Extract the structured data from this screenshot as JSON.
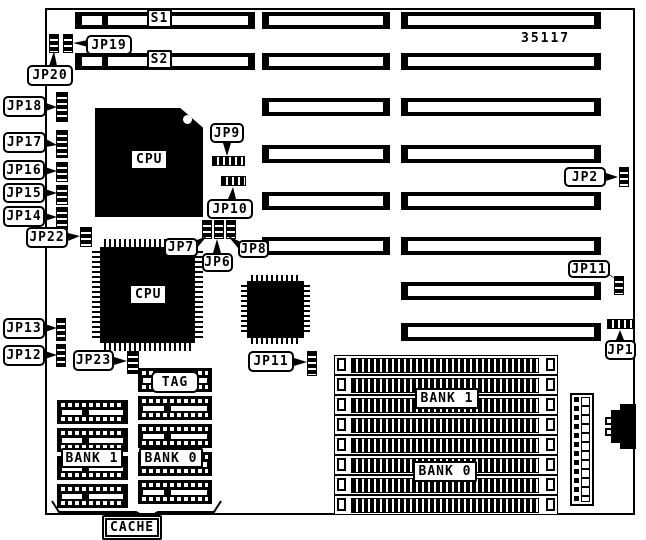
{
  "board": {
    "part_number": "35117"
  },
  "slots": {
    "s1": "S1",
    "s2": "S2"
  },
  "chips": {
    "cpu1": "CPU",
    "cpu2": "CPU"
  },
  "jumpers": {
    "jp1": "JP1",
    "jp2": "JP2",
    "jp6": "JP6",
    "jp7": "JP7",
    "jp8": "JP8",
    "jp9": "JP9",
    "jp10": "JP10",
    "jp11_right": "JP11",
    "jp11_left": "JP11",
    "jp12": "JP12",
    "jp13": "JP13",
    "jp14": "JP14",
    "jp15": "JP15",
    "jp16": "JP16",
    "jp17": "JP17",
    "jp18": "JP18",
    "jp19": "JP19",
    "jp20": "JP20",
    "jp22": "JP22",
    "jp23": "JP23"
  },
  "memory": {
    "tag": "TAG",
    "cache_bank1": "BANK 1",
    "cache_bank0": "BANK 0",
    "simm_bank1": "BANK 1",
    "simm_bank0": "BANK 0",
    "cache": "CACHE"
  }
}
